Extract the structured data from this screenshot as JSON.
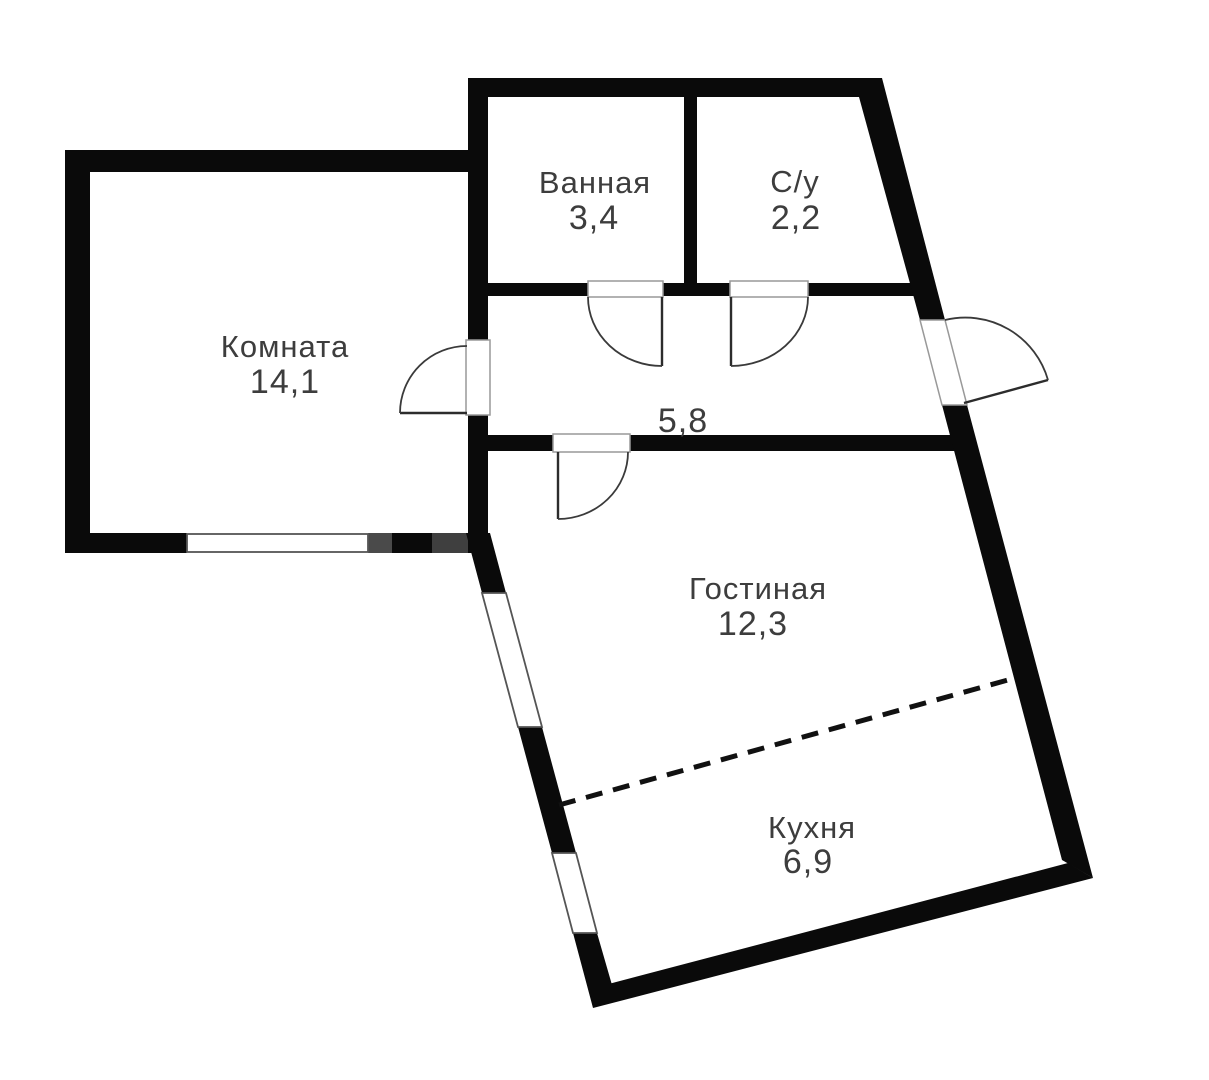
{
  "plan": {
    "type": "apartment-floor-plan",
    "colors": {
      "background": "#ffffff",
      "walls": "#0a0a0a",
      "wall_gray_segment_1": "#4a4a4a",
      "wall_gray_segment_2": "#3f3f3f",
      "text": "#3d3d3d"
    },
    "rooms": [
      {
        "id": "bathroom",
        "name": "Ванная",
        "area": "3,4"
      },
      {
        "id": "wc",
        "name": "С/у",
        "area": "2,2"
      },
      {
        "id": "room",
        "name": "Комната",
        "area": "14,1"
      },
      {
        "id": "hallway",
        "name": "",
        "area": "5,8"
      },
      {
        "id": "living-room",
        "name": "Гостиная",
        "area": "12,3"
      },
      {
        "id": "kitchen",
        "name": "Кухня",
        "area": "6,9"
      }
    ]
  }
}
